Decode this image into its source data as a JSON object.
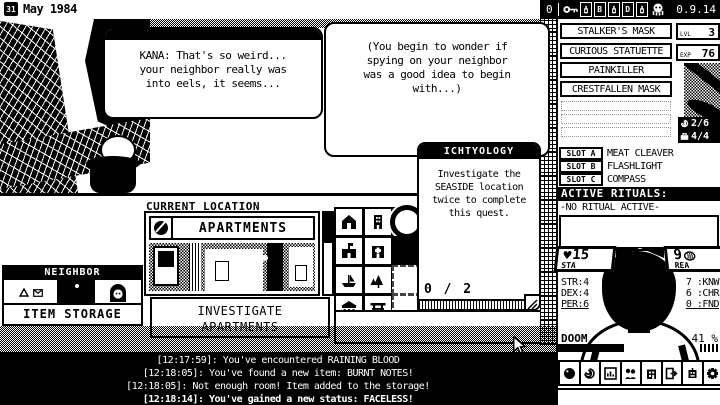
{
  "topbar": {
    "day": "31",
    "date": "May 1984",
    "counter": "0",
    "tile_b": "B",
    "tile_d": "D",
    "version": "0.9.14"
  },
  "dialogue": {
    "kana": {
      "lines": [
        "KANA: That's so weird...",
        "your neighbor really was",
        "into eels, it seems..."
      ]
    },
    "inner": {
      "lines": [
        "(You begin to wonder if",
        "spying on your neighbor",
        "was a good idea to begin",
        "with...)"
      ]
    }
  },
  "location": {
    "header": "CURRENT LOCATION",
    "name": "APARTMENTS",
    "investigate_line1": "INVESTIGATE",
    "investigate_line2": "APARTMENTS"
  },
  "ally": {
    "title": "NEIGHBOR"
  },
  "storage": {
    "label": "ITEM STORAGE"
  },
  "quest": {
    "title": "ICHTYOLOGY",
    "lines": [
      "Investigate the",
      "SEASIDE location",
      "twice to complete",
      "this quest."
    ],
    "progress": "0 / 2"
  },
  "inventory": {
    "items": [
      "STALKER'S MASK",
      "CURIOUS STATUETTE",
      "PAINKILLER",
      "CRESTFALLEN MASK"
    ],
    "lvl_label": "LVL",
    "lvl_value": "3",
    "exp_label": "EXP",
    "exp_value": "76",
    "spells_count": "2/6",
    "items_count": "4/4"
  },
  "equipment": {
    "slot_a_label": "SLOT A",
    "slot_a_item": "MEAT CLEAVER",
    "slot_b_label": "SLOT B",
    "slot_b_item": "FLASHLIGHT",
    "slot_c_label": "SLOT C",
    "slot_c_item": "COMPASS",
    "rituals_header": "ACTIVE RITUALS:",
    "rituals_status": "-NO RITUAL ACTIVE-"
  },
  "stats": {
    "sta_icon": "♥",
    "sta_value": "15",
    "sta_label": "STA",
    "rea_value": "9",
    "rea_label": "REA",
    "left": [
      "STR:4",
      "DEX:4",
      "PER:6"
    ],
    "right": [
      "7 :KNW",
      "6 :CHR",
      "0 :FND"
    ],
    "doom_label": "DOOM",
    "doom_value": "41 %"
  },
  "log": {
    "lines": [
      "[12:17:59]: You've encountered RAINING BLOOD",
      "[12:18:05]: You've found a new item: BURNT NOTES!",
      "[12:18:05]: Not enough room! Item added to the storage!",
      "[12:18:14]: You've gained a new status: FACELESS!"
    ]
  },
  "icons": {
    "topbar": [
      "calendar-icon",
      "key-icon",
      "potion-icon",
      "octopus-icon"
    ],
    "map_cells": [
      "house",
      "tower",
      "current-location",
      "school",
      "hospital",
      "unknown",
      "harbor",
      "forest",
      "empty",
      "temple",
      "torii-gate",
      "empty"
    ],
    "counters": [
      "spiral-icon",
      "briefcase-icon"
    ],
    "toolbar": [
      "orb",
      "spiral",
      "charts",
      "allies",
      "city",
      "exit",
      "building",
      "gear"
    ]
  },
  "colors": {
    "ink": "#000000",
    "paper": "#ffffff"
  }
}
